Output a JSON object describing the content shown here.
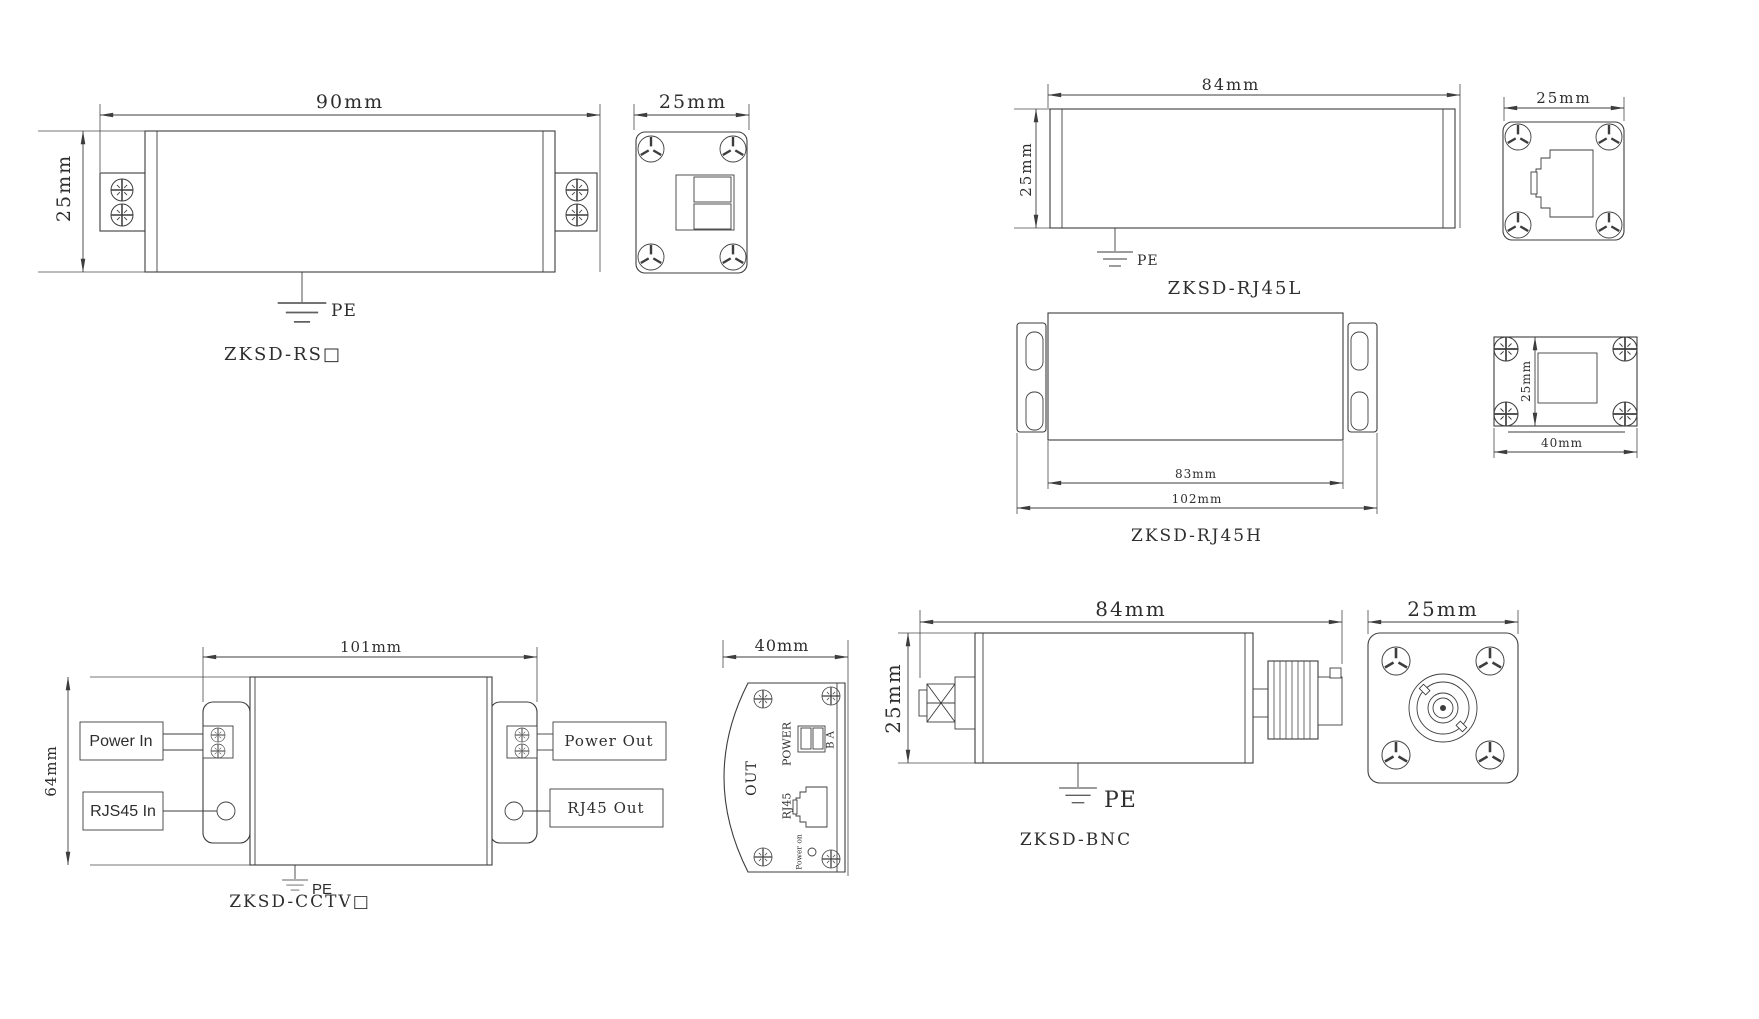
{
  "page": {
    "background": "#ffffff",
    "line_color": "#3d3d3d"
  },
  "figures": {
    "rs": {
      "model": "ZKSD-RS□",
      "front": {
        "width": "90mm",
        "height": "25mm",
        "ground": "PE"
      },
      "end": {
        "width": "25mm"
      }
    },
    "rj45l": {
      "model": "ZKSD-RJ45L",
      "front": {
        "width": "84mm",
        "height": "25mm",
        "ground": "PE"
      },
      "end": {
        "width": "25mm"
      }
    },
    "rj45h": {
      "model": "ZKSD-RJ45H",
      "front": {
        "inner_width": "83mm",
        "outer_width": "102mm"
      },
      "end": {
        "height": "25mm",
        "width": "40mm"
      }
    },
    "cctv": {
      "model": "ZKSD-CCTV□",
      "front": {
        "width": "101mm",
        "height": "64mm",
        "ground": "PE",
        "power_in": "Power In",
        "rj45_in": "RJS45 In",
        "power_out": "Power Out",
        "rj45_out": "RJ45 Out"
      },
      "end": {
        "width": "40mm",
        "out": "OUT",
        "power": "POWER",
        "terminals": "B A",
        "rj45": "RJ45",
        "power_on": "Power on"
      }
    },
    "bnc": {
      "model": "ZKSD-BNC",
      "front": {
        "width": "84mm",
        "height": "25mm",
        "ground": "PE"
      },
      "end": {
        "width": "25mm"
      }
    }
  }
}
